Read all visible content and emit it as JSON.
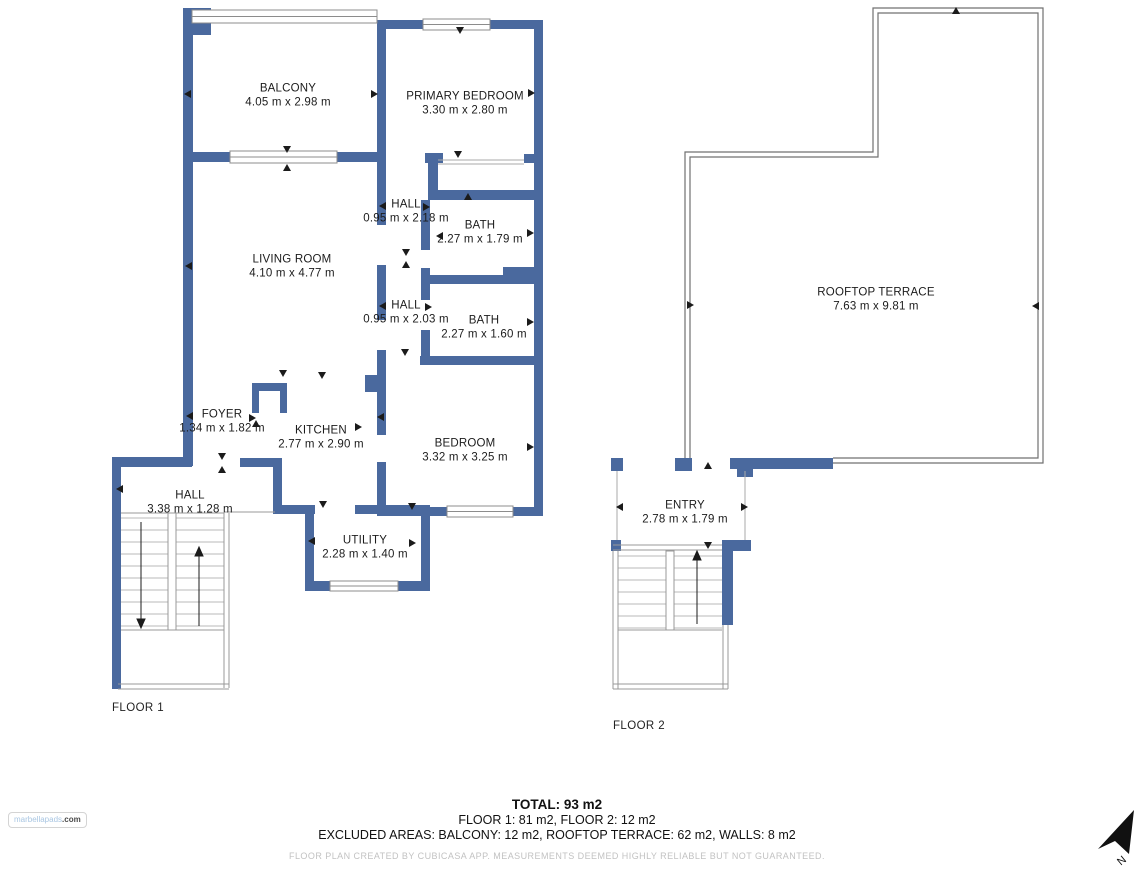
{
  "floors": {
    "floor1": {
      "label": "FLOOR 1"
    },
    "floor2": {
      "label": "FLOOR 2"
    }
  },
  "rooms": {
    "balcony": {
      "name": "BALCONY",
      "dims": "4.05 m x 2.98 m"
    },
    "primary_bedroom": {
      "name": "PRIMARY BEDROOM",
      "dims": "3.30 m x 2.80 m"
    },
    "hall_upper": {
      "name": "HALL",
      "dims": "0.95 m x 2.18 m"
    },
    "bath_upper": {
      "name": "BATH",
      "dims": "2.27 m x 1.79 m"
    },
    "living_room": {
      "name": "LIVING ROOM",
      "dims": "4.10 m x 4.77 m"
    },
    "hall_mid": {
      "name": "HALL",
      "dims": "0.95 m x 2.03 m"
    },
    "bath_lower": {
      "name": "BATH",
      "dims": "2.27 m x 1.60 m"
    },
    "foyer": {
      "name": "FOYER",
      "dims": "1.34 m x 1.82 m"
    },
    "kitchen": {
      "name": "KITCHEN",
      "dims": "2.77 m x 2.90 m"
    },
    "bedroom": {
      "name": "BEDROOM",
      "dims": "3.32 m x 3.25 m"
    },
    "hall_lower": {
      "name": "HALL",
      "dims": "3.38 m x 1.28 m"
    },
    "utility": {
      "name": "UTILITY",
      "dims": "2.28 m x 1.40 m"
    },
    "rooftop_terrace": {
      "name": "ROOFTOP TERRACE",
      "dims": "7.63 m x 9.81 m"
    },
    "entry": {
      "name": "ENTRY",
      "dims": "2.78 m x 1.79 m"
    }
  },
  "summary": {
    "total": "TOTAL: 93 m2",
    "floor_areas": "FLOOR 1: 81 m2, FLOOR 2: 12 m2",
    "excluded": "EXCLUDED AREAS: BALCONY: 12 m2, ROOFTOP TERRACE: 62 m2, WALLS: 8 m2"
  },
  "disclaimer": "FLOOR PLAN CREATED BY CUBICASA APP. MEASUREMENTS DEEMED HIGHLY RELIABLE BUT NOT GUARANTEED.",
  "logo": {
    "brand": "marbellapads",
    "tld": ".com"
  },
  "compass": {
    "label": "N"
  },
  "colors": {
    "wall": "#4a699e",
    "outline": "#8c8c8c",
    "stair_tread": "#b8b8b8",
    "terrace_outline": "#707070",
    "text": "#1c1c1c",
    "muted_text": "#c2c2c2"
  }
}
